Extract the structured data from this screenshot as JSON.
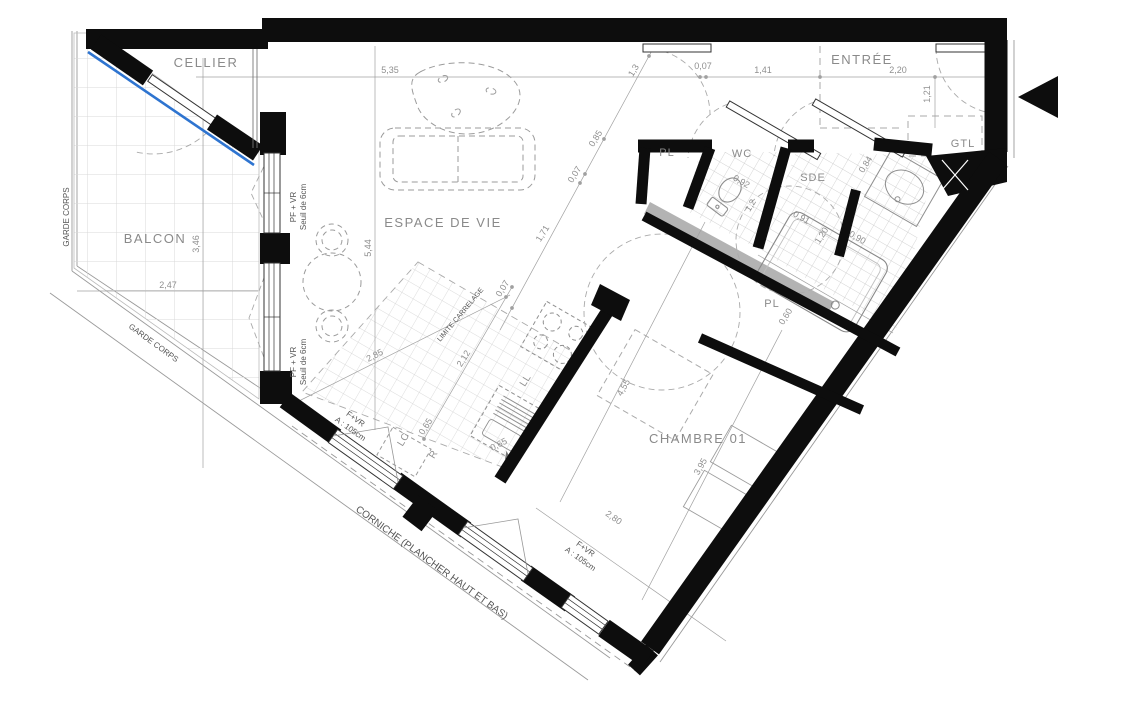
{
  "drawing": {
    "title": "apartment-floor-plan",
    "rooms": {
      "cellier": "CELLIER",
      "balcon": "BALCON",
      "espace": "ESPACE DE VIE",
      "entree": "ENTRÉE",
      "pl1": "PL",
      "wc": "WC",
      "sde": "SDE",
      "gtl": "GTL",
      "pl2": "PL",
      "chambre": "CHAMBRE 01"
    },
    "annotations": {
      "garde_corps_1": "GARDE CORPS",
      "garde_corps_2": "GARDE CORPS",
      "corniche": "CORNICHE (PLANCHER HAUT ET BAS)",
      "limite_carrelage": "LIMITE CARRELAGE",
      "win1_type": "PF + VR",
      "win1_sill": "Seuil de 6cm",
      "win2_type": "PF + VR",
      "win2_sill": "Seuil de 6cm",
      "win3_type": "F+VR",
      "win3_height": "A : 105cm",
      "win4_type": "F+VR",
      "win4_height": "A : 105cm",
      "washer": "LL",
      "fridge": "R",
      "laundry_column": "LC"
    },
    "dims": {
      "d535": "5,35",
      "d007a": "0,07",
      "d141": "1,41",
      "d220": "2,20",
      "d121": "1,21",
      "d13": "1,3",
      "d085": "0,85",
      "d007b": "0,07",
      "d171": "1,71",
      "d544": "5,44",
      "d346": "3,46",
      "d247": "2,47",
      "d285": "2,85",
      "d212": "2,12",
      "d007c": "0,07",
      "d065a": "0,65",
      "d065b": "0,65",
      "d092": "0,92",
      "d12": "1,2",
      "d091": "0,91",
      "d084": "0,84",
      "d120": "1,20",
      "d090": "0,90",
      "d060": "0,60",
      "d455": "4,55",
      "d395": "3,95",
      "d280": "2,80"
    },
    "colors": {
      "wall": "#0d0d0d",
      "facade_line": "#2e74d0",
      "duct": "#b3b3b3",
      "dim_text": "#8f8f8f",
      "tile": "#c4c4c4"
    }
  }
}
